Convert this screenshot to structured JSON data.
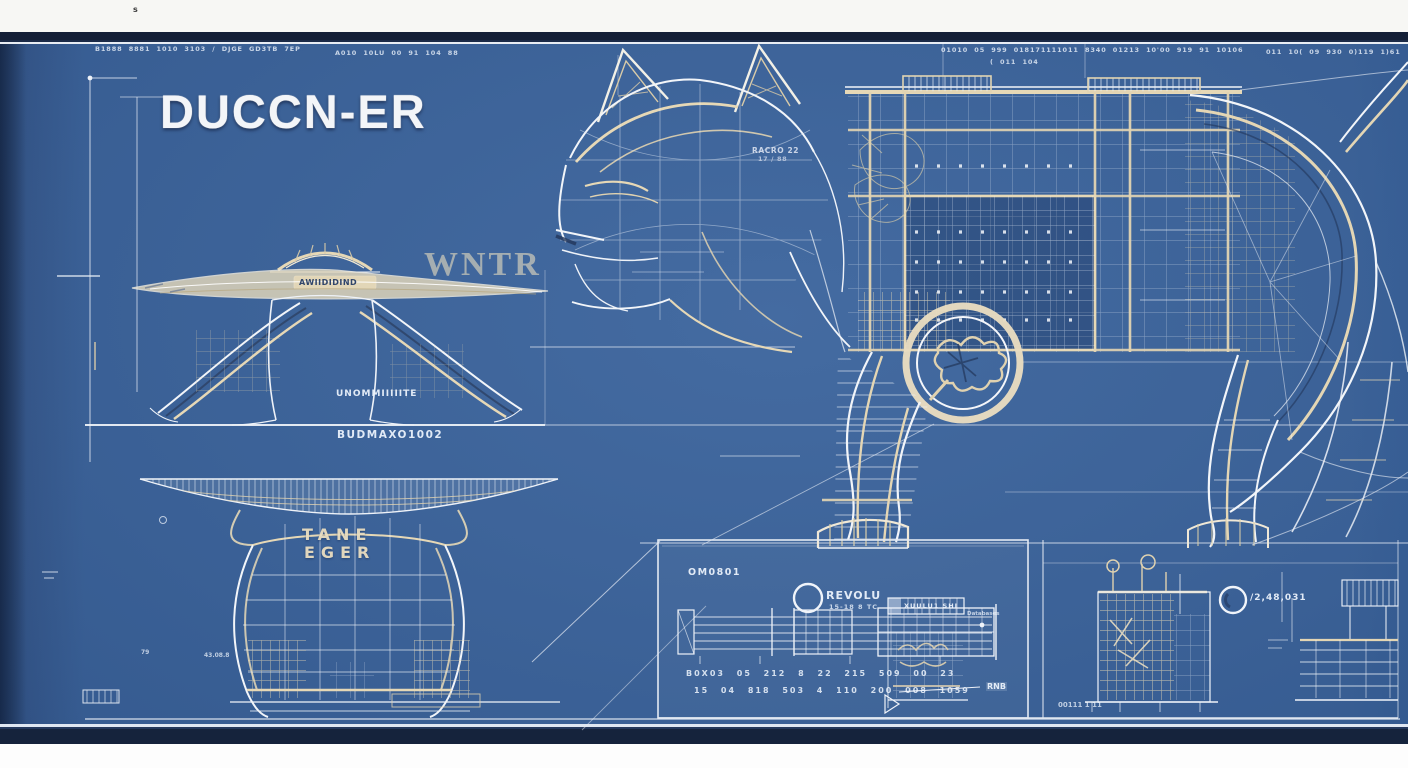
{
  "colors": {
    "blueprint_blue": "#3a639c",
    "border_navy": "#15233c",
    "paper_white": "#f7f7f4",
    "line_white": "#eef2f8",
    "line_cream": "#e4d6b4"
  },
  "margin_mark": "s",
  "annotations": {
    "top_left_1": "B1888 8881 1010 3103 / DJGE GD3TB 7EP",
    "top_left_2": "A010 10LU 00 91 104 88",
    "top_right_1": "01010 05 999 018171111011  8340 01213 10'00 919 91 10106",
    "top_right_2": "( 011 104",
    "top_far_right": "011 10( 09 930 0)119 1)61"
  },
  "title": "DUCCN-ER",
  "figure": {
    "head_label_line1": "RACRO 22",
    "head_label_line2": "17 / 88"
  },
  "side_elevation": {
    "dome_label": "AWIIDIDIND",
    "watermark": "WNTR",
    "mid_label": "UNOMMIIIIITE",
    "bottom_label": "BUDMAXO1002"
  },
  "front_elevation": {
    "block_label_line1": "TANE",
    "block_label_line2": "EGER",
    "tiny_label": "43.08.8",
    "axis_mark": "79"
  },
  "panel_main": {
    "title": "OM0801",
    "circle_label": "REVOLU",
    "circle_sublabel": "15-18 8 TC",
    "table_rows": [
      "B0X03 05 212 8 22 215 509 00 23",
      "15 04 818 503 4 110 200 008 1059"
    ],
    "strip_label": "XUULU1 SHI",
    "strip_note": "Databases",
    "dim_label": "RNB"
  },
  "panel_right": {
    "base_label": "00111 1 11",
    "circle_label": "/2,48,031"
  }
}
